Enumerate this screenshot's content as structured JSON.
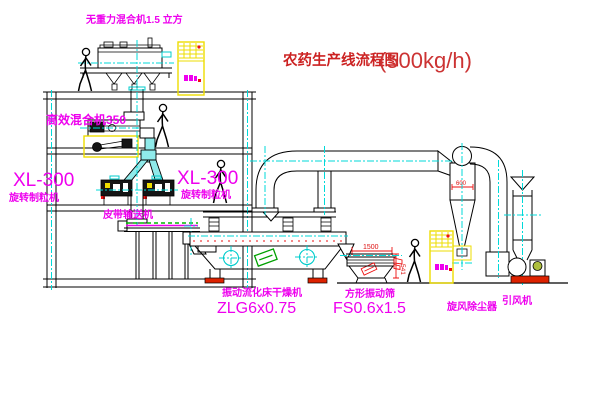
{
  "title": {
    "name": "农药生产线流程图",
    "capacity": "(500kg/h)"
  },
  "labels": {
    "gravity_mixer": "无重力混合机1.5 立方",
    "high_eff_mixer": "高效混合机350",
    "granulator_left_model": "XL-300",
    "granulator_left_name": "旋转制粒机",
    "granulator_right_model": "XL-300",
    "granulator_right_name": "旋转制粒机",
    "belt_conveyor": "皮带输送机",
    "dryer_name": "振动流化床干燥机",
    "dryer_model": "ZLG6x0.75",
    "sieve_name": "方形振动筛",
    "sieve_model": "FS0.6x1.5",
    "cyclone_name": "旋风除尘器",
    "fan_name": "引风机"
  },
  "dimensions": {
    "sieve_length": "1500",
    "sieve_height": "541",
    "cyclone_body": "600"
  },
  "colors": {
    "label_magenta": "#ee00ee",
    "title_red": "#cc2222",
    "dimension_red": "#ee1111",
    "centerline_cyan": "#00d9d9",
    "cabinet_yellow": "#eedd00",
    "chute_cyan": "#8feaea",
    "logo_green": "#00a000",
    "base_red": "#dd2200"
  }
}
